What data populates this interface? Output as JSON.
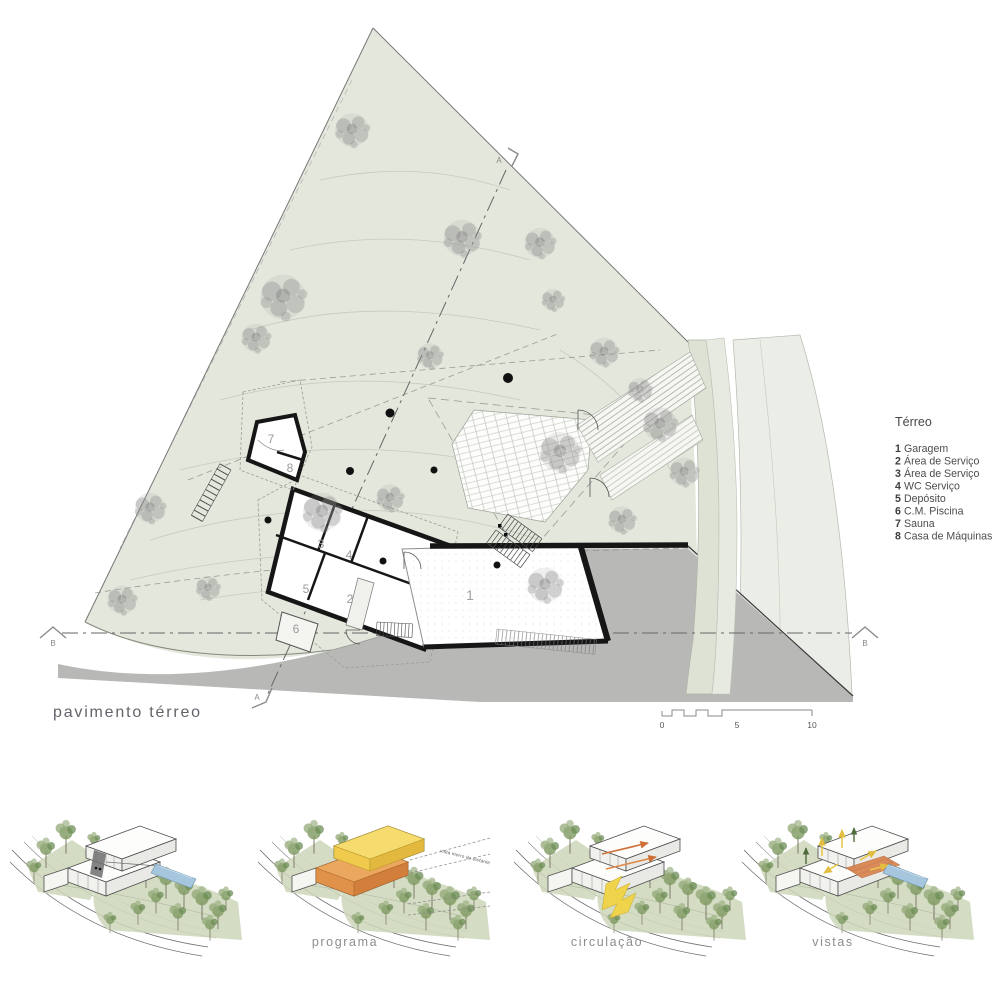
{
  "sheet": {
    "caption": "pavimento térreo"
  },
  "legend": {
    "title": "Térreo",
    "items": [
      {
        "num": "1",
        "label": "Garagem"
      },
      {
        "num": "2",
        "label": "Área de Serviço"
      },
      {
        "num": "3",
        "label": "Área de Serviço"
      },
      {
        "num": "4",
        "label": "WC Serviço"
      },
      {
        "num": "5",
        "label": "Depósito"
      },
      {
        "num": "6",
        "label": "C.M. Piscina"
      },
      {
        "num": "7",
        "label": "Sauna"
      },
      {
        "num": "8",
        "label": "Casa de Máquinas"
      }
    ]
  },
  "plan": {
    "rooms": [
      "1",
      "2",
      "3",
      "4",
      "5",
      "6",
      "7",
      "8"
    ],
    "section_letter_a": "A",
    "section_letter_b": "B"
  },
  "scalebar": {
    "t0": "0",
    "t5": "5",
    "t10": "10"
  },
  "diagrams": {
    "d2_label": "programa",
    "d2_annotation": "vista morro do elefante",
    "d3_label": "circulação",
    "d4_label": "vistas"
  },
  "colors": {
    "site_green": "#e3e7dc",
    "road_gray": "#b8b9b6",
    "wall_black": "#161616",
    "tree_gray": "#8d8d8d",
    "pool_blue": "#a6c6de",
    "program_yellow": "#f6dc6e",
    "program_orange": "#eca75f",
    "circulation_yellow": "#eed34b",
    "arrow_orange": "#cf6f38",
    "diagram_green": "#ccd6b9"
  }
}
